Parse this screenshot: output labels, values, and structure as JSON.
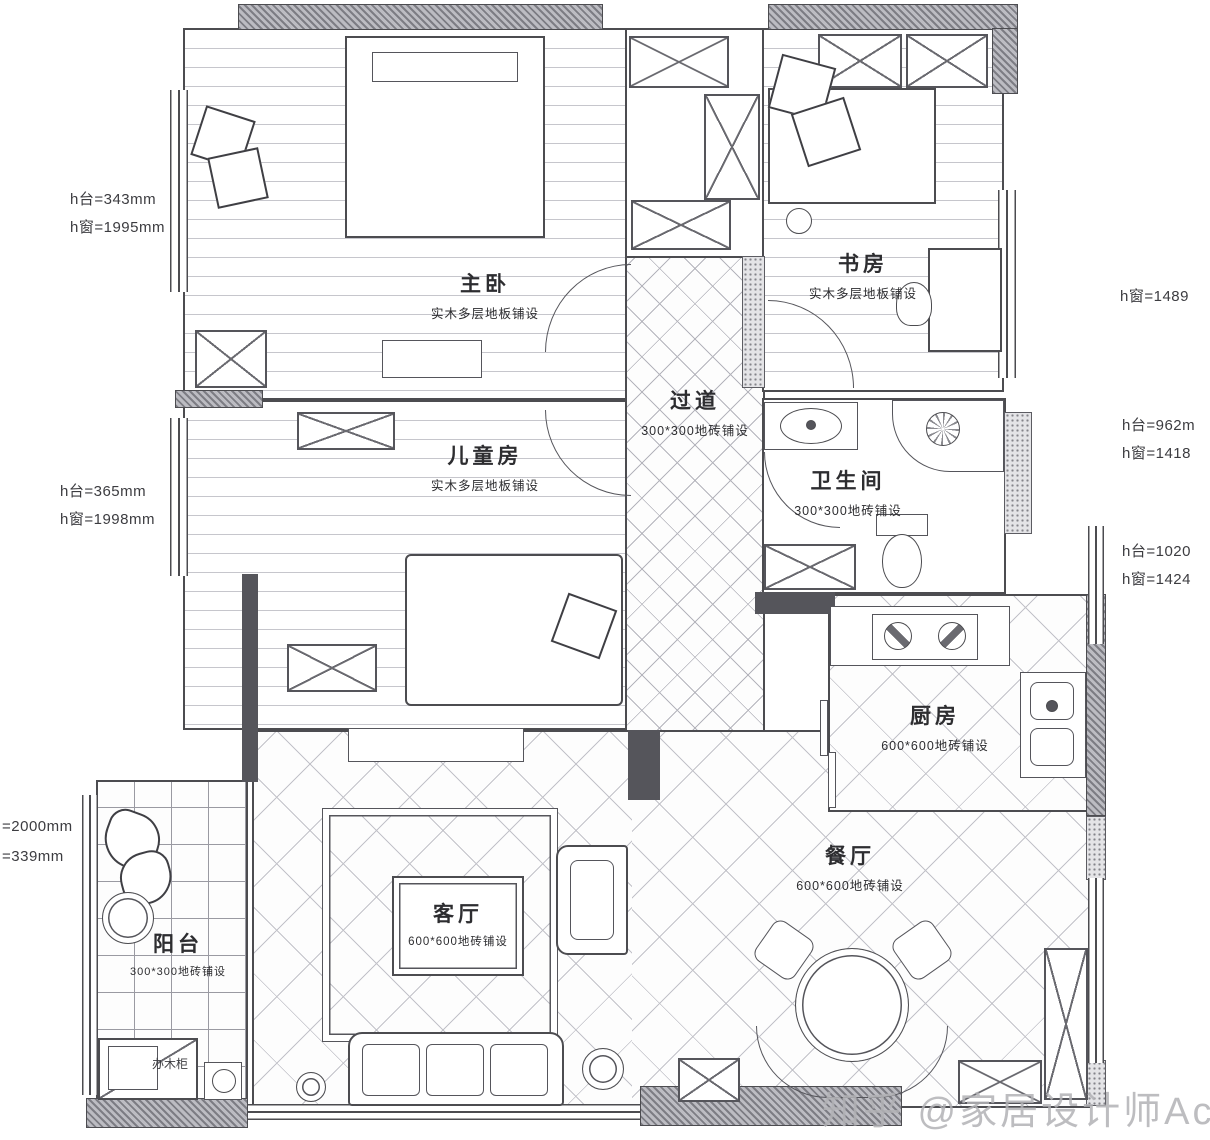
{
  "watermark": "知乎 @家居设计师Acc",
  "colors": {
    "line": "#4c4c50",
    "wall_fill": "#8a8a90",
    "background": "#ffffff",
    "watermark": "#b2b2b6"
  },
  "rooms": {
    "master": {
      "name": "主卧",
      "floor": "实木多层地板铺设"
    },
    "children": {
      "name": "儿童房",
      "floor": "实木多层地板铺设"
    },
    "study": {
      "name": "书房",
      "floor": "实木多层地板铺设"
    },
    "corridor": {
      "name": "过道",
      "floor": "300*300地砖铺设"
    },
    "bathroom": {
      "name": "卫生间",
      "floor": "300*300地砖铺设"
    },
    "kitchen": {
      "name": "厨房",
      "floor": "600*600地砖铺设"
    },
    "dining": {
      "name": "餐厅",
      "floor": "600*600地砖铺设"
    },
    "living": {
      "name": "客厅",
      "floor": "600*600地砖铺设"
    },
    "balcony": {
      "name": "阳台",
      "floor": "300*300地砖铺设"
    }
  },
  "labels": {
    "balcony_cabinet": "办木柜"
  },
  "dims": {
    "left_top_sill": "h台=343mm",
    "left_top_window": "h窗=1995mm",
    "left_mid_sill": "h台=365mm",
    "left_mid_window": "h窗=1998mm",
    "right_top_window": "h窗=1489",
    "right_mid_sill": "h台=962m",
    "right_mid_window": "h窗=1418",
    "right_low_sill": "h台=1020",
    "right_low_window": "h窗=1424",
    "bottom_left_window": "=2000mm",
    "bottom_left_sill": "=339mm"
  }
}
